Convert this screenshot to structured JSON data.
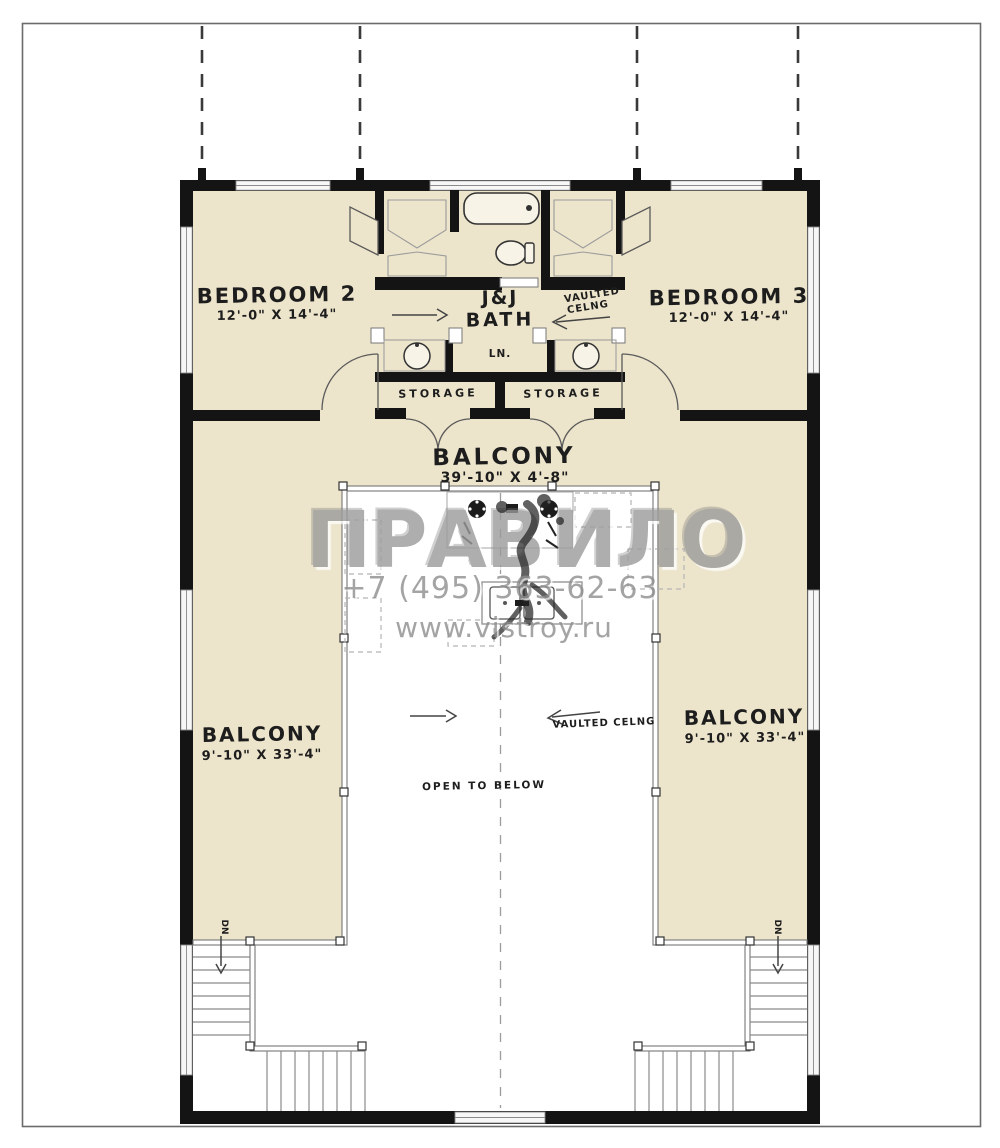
{
  "page": {
    "background": "#ffffff",
    "frame_color": "#6b6b6b"
  },
  "colors": {
    "floor": "#ece4cb",
    "wall": "#141414",
    "thin_line": "#777777",
    "watermark": "#9b9b9b"
  },
  "watermark": {
    "brand_left": "ПРАВ",
    "brand_right": "ИЛО",
    "phone": "+7 (495) 363-62-63",
    "website": "www.vistroy.ru"
  },
  "rooms": {
    "bedroom2": {
      "label": "BEDROOM 2",
      "dims": "12'-0\" X 14'-4\""
    },
    "bedroom3": {
      "label": "BEDROOM 3",
      "dims": "12'-0\" X 14'-4\""
    },
    "bath": {
      "line1": "J&J",
      "line2": "BATH"
    },
    "linen": {
      "label": "LN."
    },
    "storage_left": {
      "label": "STORAGE"
    },
    "storage_right": {
      "label": "STORAGE"
    },
    "balcony_top": {
      "label": "BALCONY",
      "dims": "39'-10\" X 4'-8\""
    },
    "balcony_left": {
      "label": "BALCONY",
      "dims": "9'-10\" X 33'-4\""
    },
    "balcony_right": {
      "label": "BALCONY",
      "dims": "9'-10\" X 33'-4\""
    }
  },
  "annotations": {
    "vaulted_top_line1": "VAULTED",
    "vaulted_top_line2": "CELNG",
    "vaulted_bottom": "VAULTED CELNG",
    "open_to_below": "OPEN TO BELOW",
    "dn_left": "DN",
    "dn_right": "DN"
  }
}
